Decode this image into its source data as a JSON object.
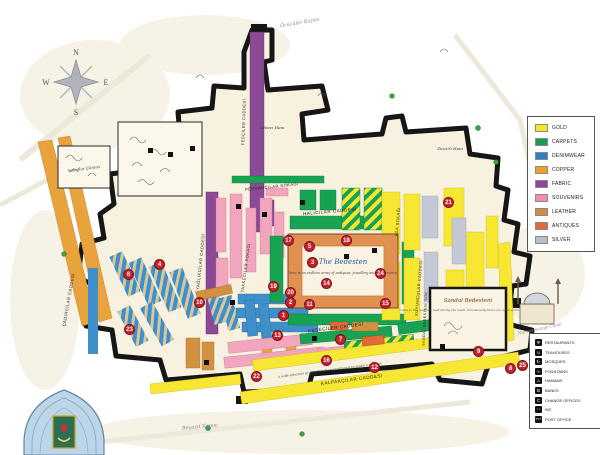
{
  "compass": {
    "north": "N",
    "east": "E",
    "south": "S",
    "west": "W"
  },
  "legend": {
    "items": [
      {
        "label": "GOLD",
        "color": "#f6e72d"
      },
      {
        "label": "CARPETS",
        "color": "#169c52"
      },
      {
        "label": "DENIMWEAR",
        "color": "#2b7fc3"
      },
      {
        "label": "COPPER",
        "color": "#f0a02a"
      },
      {
        "label": "FABRIC",
        "color": "#8b4996"
      },
      {
        "label": "SOUVENIRS",
        "color": "#ef8f9f"
      },
      {
        "label": "LEATHER",
        "color": "#d08c3e"
      },
      {
        "label": "ANTIQUES",
        "color": "#e06a38"
      },
      {
        "label": "SILVER",
        "color": "#b9bec6"
      }
    ]
  },
  "facilities": {
    "items": [
      {
        "label": "RESTAURANTS",
        "glyph": "Ψ"
      },
      {
        "label": "TEAHOUSES",
        "glyph": "∪"
      },
      {
        "label": "MOSQUES",
        "glyph": "☪"
      },
      {
        "label": "FOUNTAINS",
        "glyph": "≈"
      },
      {
        "label": "HAMAMS",
        "glyph": "♨"
      },
      {
        "label": "BANKS",
        "glyph": "B"
      },
      {
        "label": "CHANGE OFFICES",
        "glyph": "C"
      },
      {
        "label": "WC",
        "glyph": "♂♀"
      },
      {
        "label": "POST OFFICE",
        "glyph": "PTT"
      }
    ]
  },
  "streets": [
    "KALPAKÇILAR CADDESİ",
    "KESECİLER CADDESİ",
    "HALICILAR CADDESİ",
    "PERDAHÇILAR SOKAĞI",
    "TAKKECİLER SOKAĞI",
    "YAĞLIKÇILAR CADDESİ",
    "ÇADIRCILAR CADDESİ",
    "KUYUMCULAR CADDESİ",
    "AĞA SOKAĞI",
    "FESÇİLER CADDESİ",
    "SANDAL BEDESTENİ SOK."
  ],
  "places": {
    "bedesten_title": "The Bedesten",
    "bedesten_note": "here is an endless array of antiques, jewellery and copperware",
    "sandal_title": "Sandal Bedesteni",
    "sandal_note": "Come to the auctions held during the week. Occasionally there are some great bargains...",
    "street_note": "a wide selection of jewellery from traditional to modern settings",
    "cebeci_han": "Cebeci Hanı",
    "zincirli_han": "Zincirli Hanı",
    "sahaflar": "Sahaflar Çarşısı",
    "oruculer_gate": "Örücüler Kapısı",
    "beyazit_gate": "Beyazıt Kapısı",
    "nuruosmaniye": "Nuruosmaniye Camii"
  },
  "markers": [
    "1",
    "2",
    "3",
    "4",
    "5",
    "6",
    "7",
    "8",
    "9",
    "10",
    "11",
    "12",
    "13",
    "14",
    "15",
    "16",
    "17",
    "18",
    "19",
    "20",
    "21",
    "22",
    "23",
    "24",
    "25"
  ]
}
